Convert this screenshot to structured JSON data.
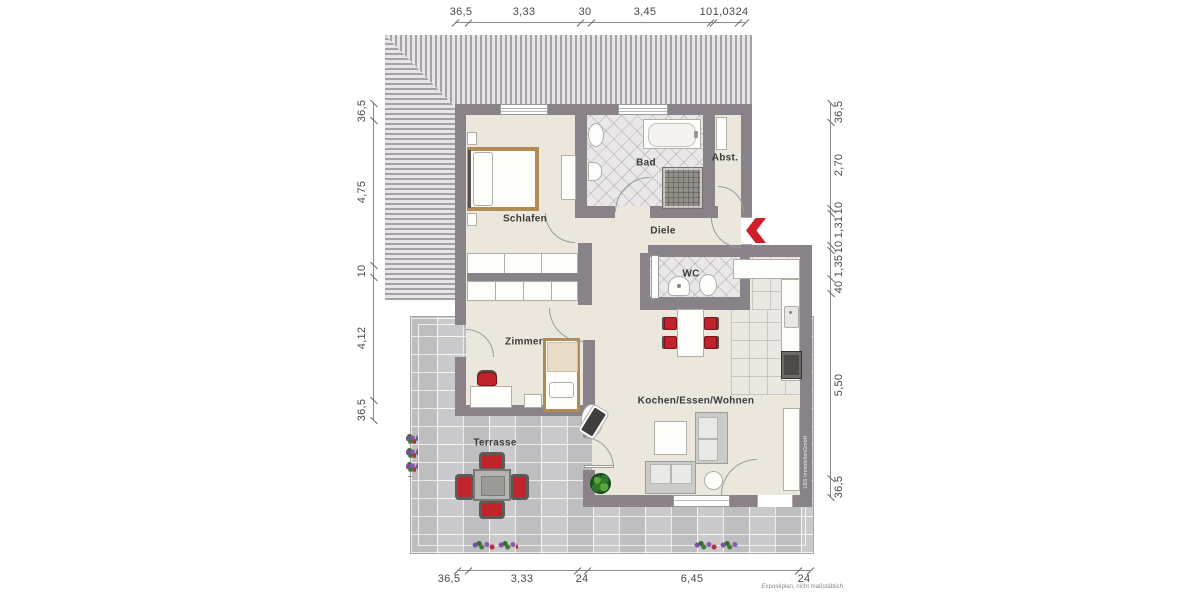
{
  "meta": {
    "plan_note": "Exposéplan, nicht maßstäblich",
    "watermark": "LBS ImmobilienGmbH"
  },
  "rooms": {
    "schlafen": "Schlafen",
    "bad": "Bad",
    "abst": "Abst.",
    "diele": "Diele",
    "wc": "WC",
    "zimmer": "Zimmer",
    "wohnen": "Kochen/Essen/Wohnen",
    "terrasse": "Terrasse"
  },
  "dims": {
    "top": [
      "36,5",
      "3,33",
      "30",
      "3,45",
      "10",
      "1,03",
      "24"
    ],
    "left": [
      "36,5",
      "4,75",
      "10",
      "4,12",
      "36,5"
    ],
    "right": [
      "36,5",
      "2,70",
      "10",
      "1,31",
      "10",
      "1,35",
      "40",
      "5,50",
      "36,5"
    ],
    "bottom": [
      "36,5",
      "3,33",
      "24",
      "6,45",
      "24"
    ]
  },
  "colors": {
    "wall": "#8a8289",
    "floor": "#ebe7dc",
    "terrace": "#c7c7c9",
    "accent_red": "#d01f2a",
    "roof_dark": "#a5a1a7",
    "roof_light": "#e7e5e8"
  }
}
